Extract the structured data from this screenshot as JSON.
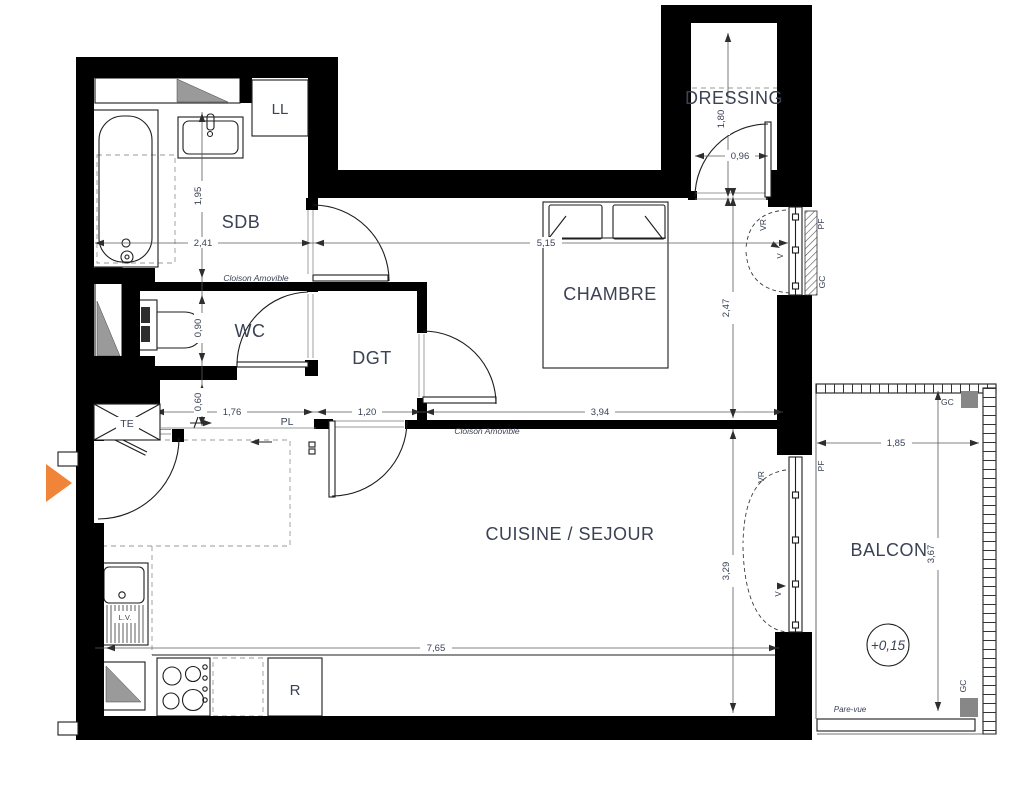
{
  "plan": {
    "rooms": {
      "sdb": "SDB",
      "wc": "WC",
      "dgt": "DGT",
      "chambre": "CHAMBRE",
      "dressing": "DRESSING",
      "cuisine_sejour": "CUISINE / SEJOUR",
      "balcon": "BALCON"
    },
    "fixtures": {
      "washing_machine": "LL",
      "electrical_panel": "TE",
      "closet": "PL",
      "fridge": "R",
      "dishwasher": "L.V."
    },
    "annotations": {
      "partition_sdb": "Cloison Amovible",
      "partition_sejour": "Cloison Amovible",
      "pare_vue": "Pare-vue",
      "level": "+0,15",
      "vr_chambre": "VR",
      "vr_sejour": "VR",
      "v_chambre": "V",
      "v_sejour": "V",
      "pf_chambre": "PF",
      "pf_balcon": "PF",
      "gc_chambre": "GC",
      "gc_balcon_top": "GC",
      "gc_balcon_bottom": "GC"
    },
    "dimensions": {
      "sdb_width": "2,41",
      "chambre_width": "5,15",
      "sdb_depth": "1,95",
      "wc_depth": "0,90",
      "entry_depth": "0,60",
      "entry_width": "1,76",
      "dgt_width": "1,20",
      "chambre_south_width": "3,94",
      "chambre_depth": "2,47",
      "dressing_depth": "1,80",
      "dressing_door_width": "0,96",
      "sejour_depth": "3,29",
      "sejour_width": "7,65",
      "balcon_width": "1,85",
      "balcon_depth": "3,67"
    },
    "colors": {
      "wall": "#000000",
      "text": "#3a4254",
      "accent": "#F08438",
      "shade": "#9a9a9a"
    }
  }
}
